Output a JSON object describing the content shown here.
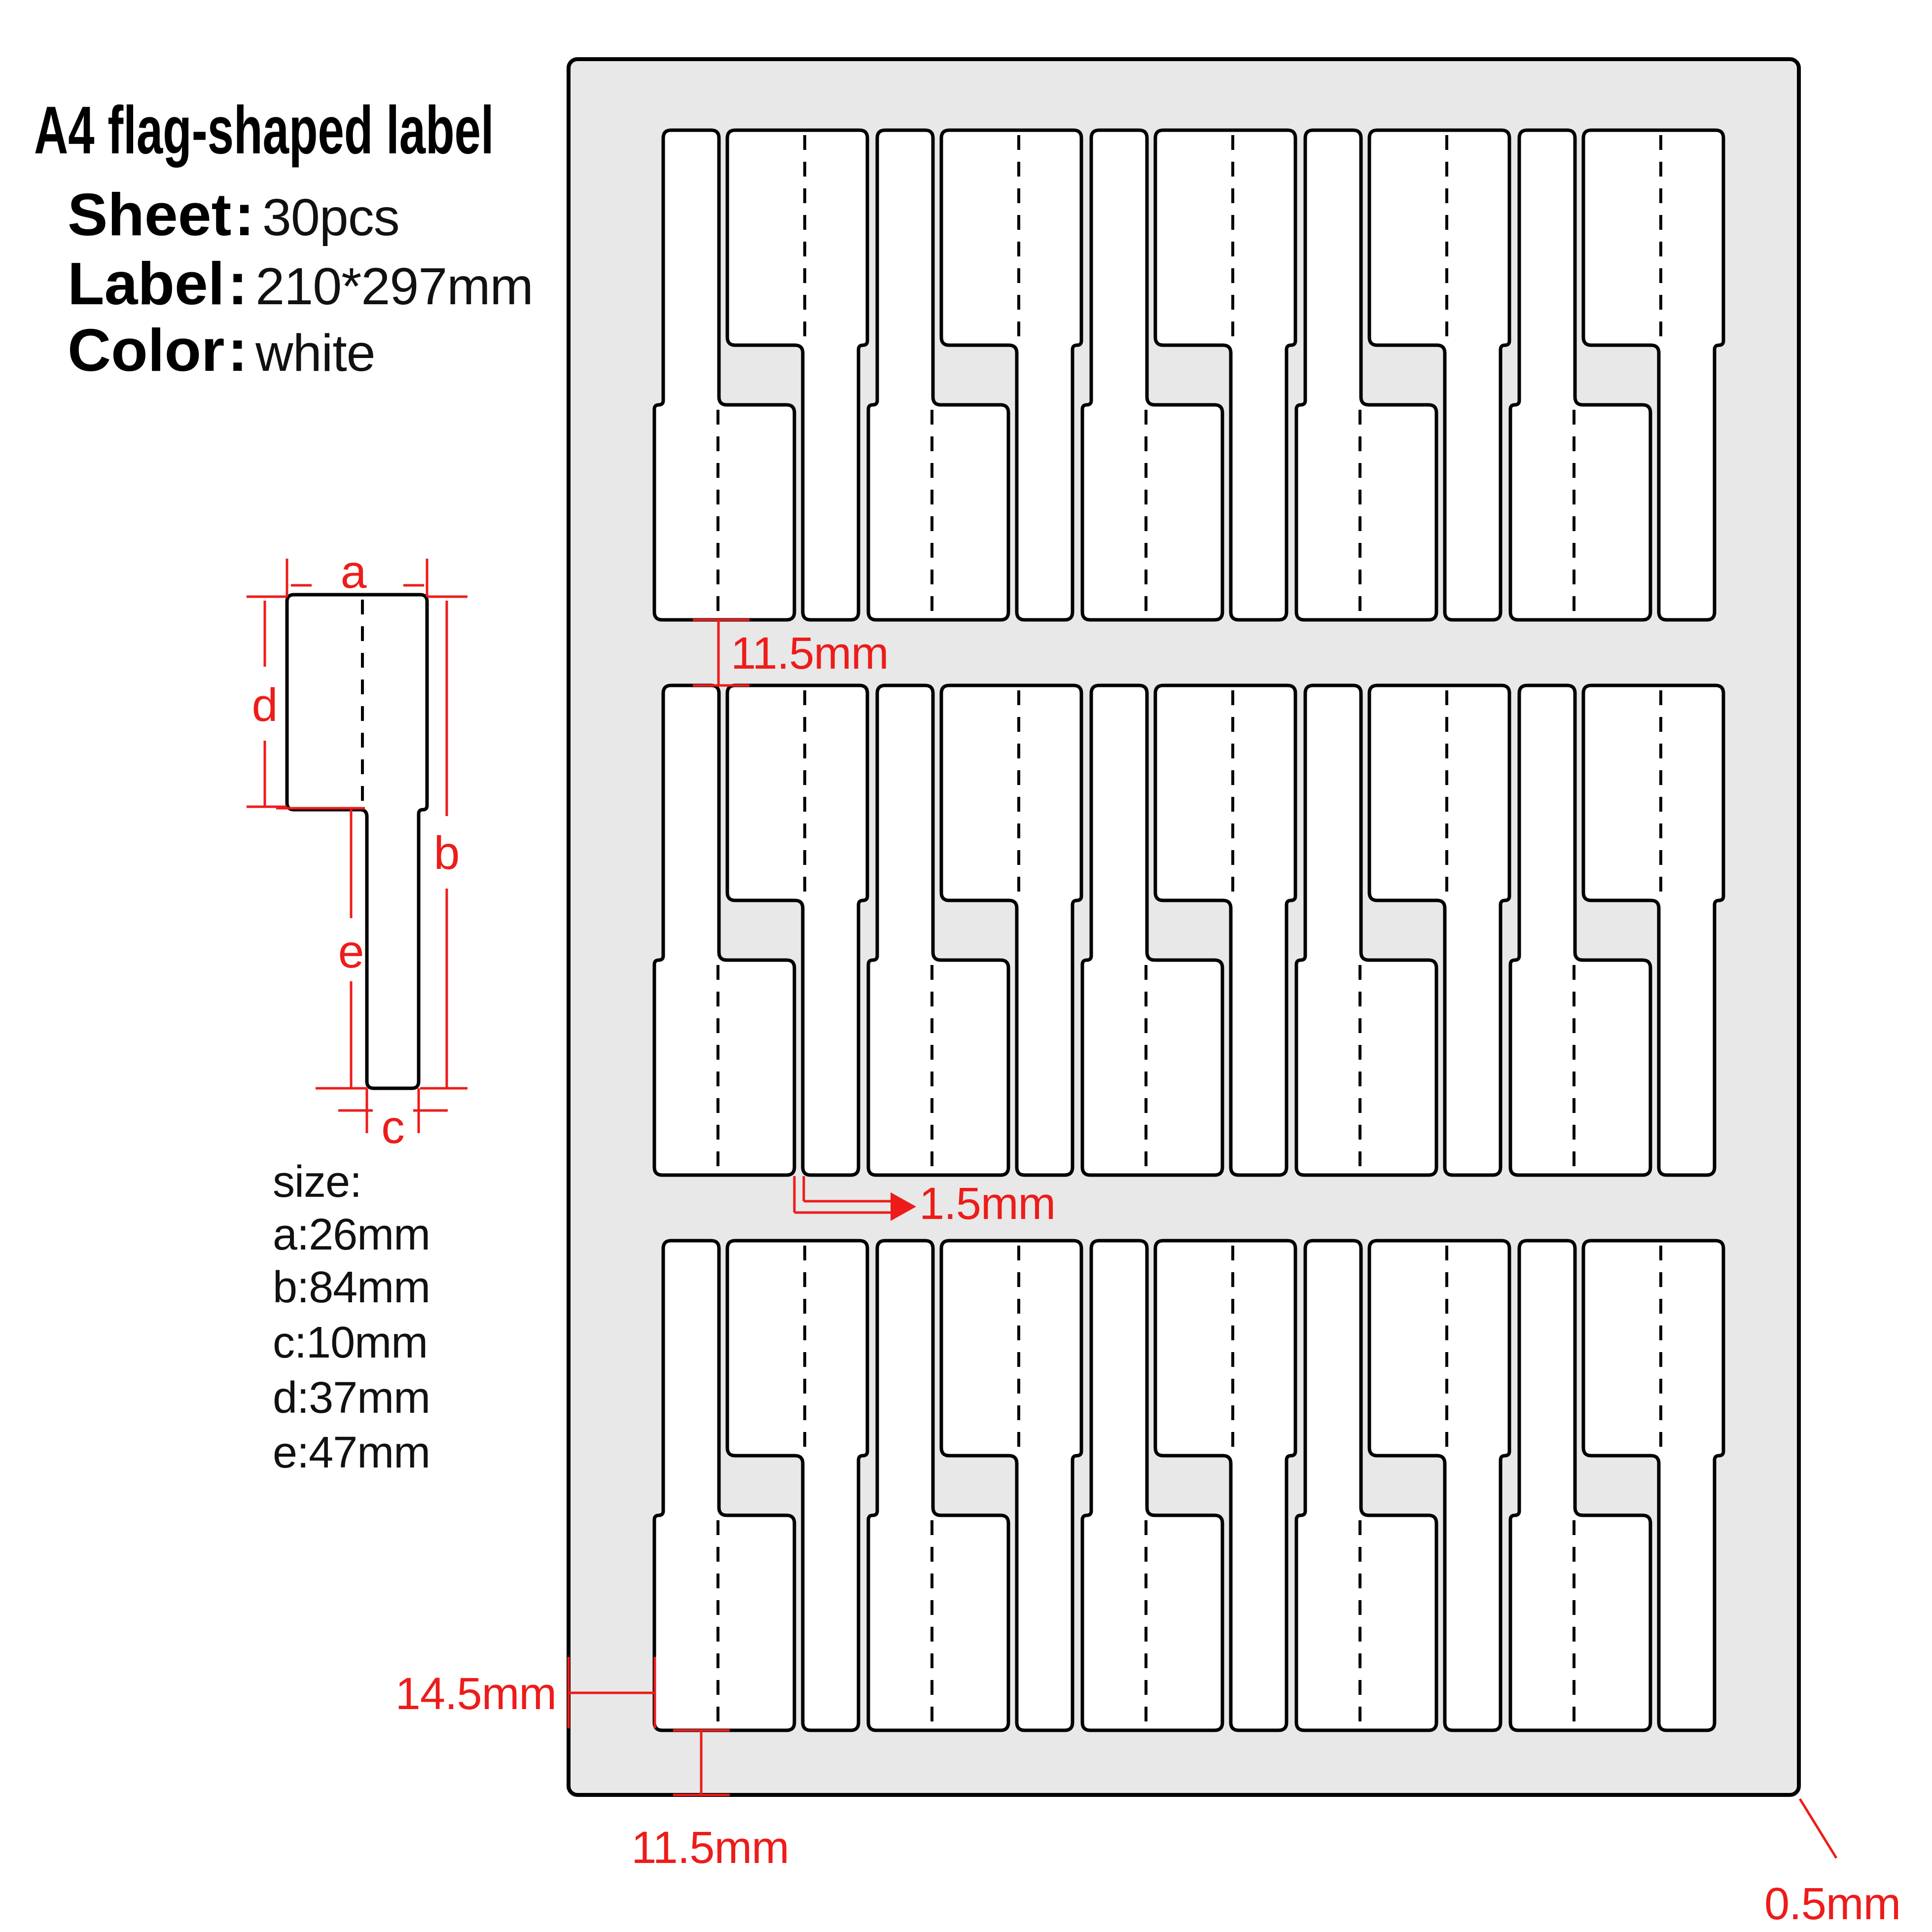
{
  "title": "A4 flag-shaped label",
  "punct": {
    "colon": ":"
  },
  "specs": [
    {
      "label": "Sheet",
      "value": "30pcs"
    },
    {
      "label": "Label",
      "value": "210*297mm"
    },
    {
      "label": "Color",
      "value": "white"
    }
  ],
  "size_list": {
    "heading": "size",
    "items": [
      {
        "key": "a",
        "value": "26mm"
      },
      {
        "key": "b",
        "value": "84mm"
      },
      {
        "key": "c",
        "value": "10mm"
      },
      {
        "key": "d",
        "value": "37mm"
      },
      {
        "key": "e",
        "value": "47mm"
      }
    ]
  },
  "sheet": {
    "rows": 3,
    "labels_per_row": 10,
    "total_labels": 30
  },
  "annotations": {
    "row_gap": "11.5mm",
    "stem_offset": "1.5mm",
    "left_margin": "14.5mm",
    "bottom_margin": "11.5mm",
    "corner_gap": "0.5mm"
  },
  "colors": {
    "accent_red": "#ed1c1a",
    "sheet_gray": "#e8e8e8",
    "label_fill": "#ffffff",
    "outline_black": "#000000"
  }
}
